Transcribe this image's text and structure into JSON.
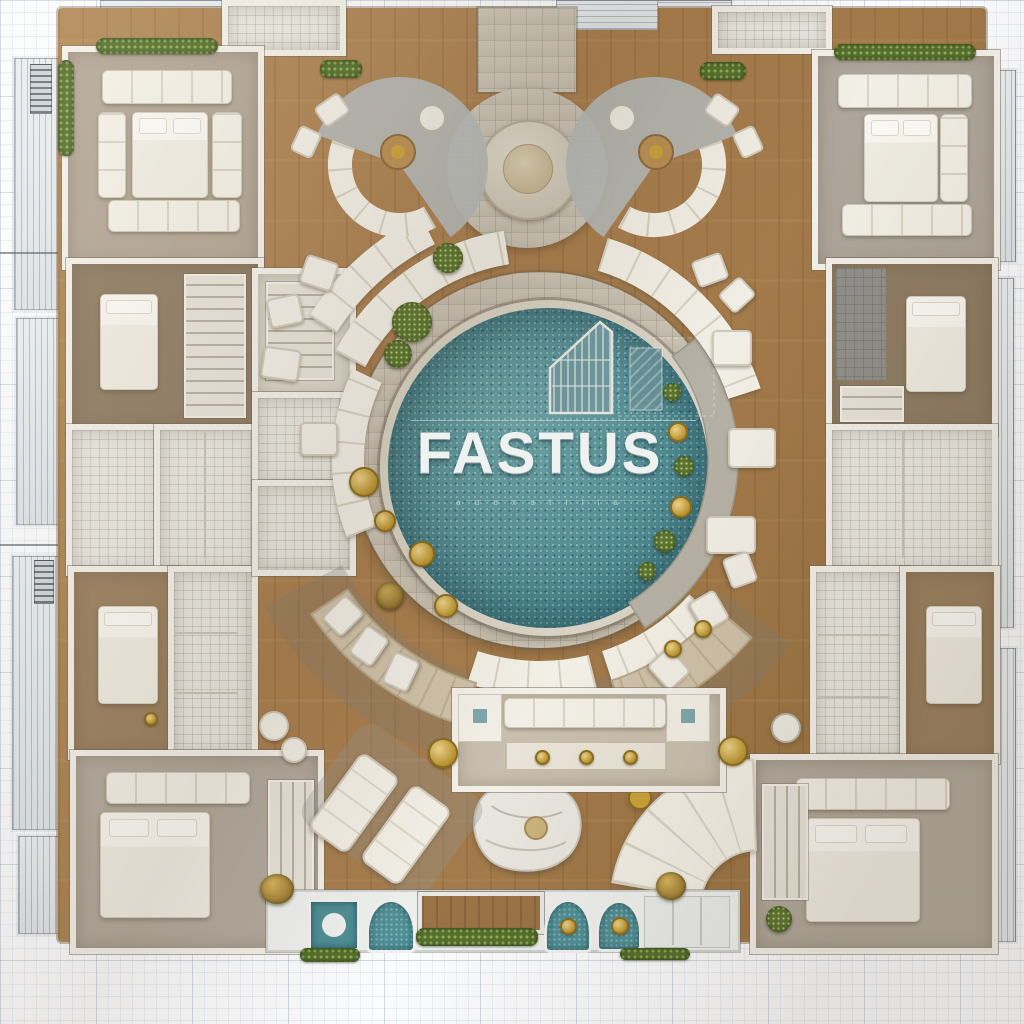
{
  "pool": {
    "title": "FASTUS",
    "tagline": "a u o x a t i l i a"
  },
  "palette": {
    "pool_teal": "#54929a",
    "wood_floor": "#a87e4f",
    "wall_white": "#f3f0e9",
    "sofa_cream": "#f1eee5",
    "rug_grey": "#b2a99d",
    "stone_walk": "#c6bfae",
    "hedge_green": "#56702e",
    "gold_accent": "#c39a38",
    "blueprint_line": "#96a8bb"
  }
}
